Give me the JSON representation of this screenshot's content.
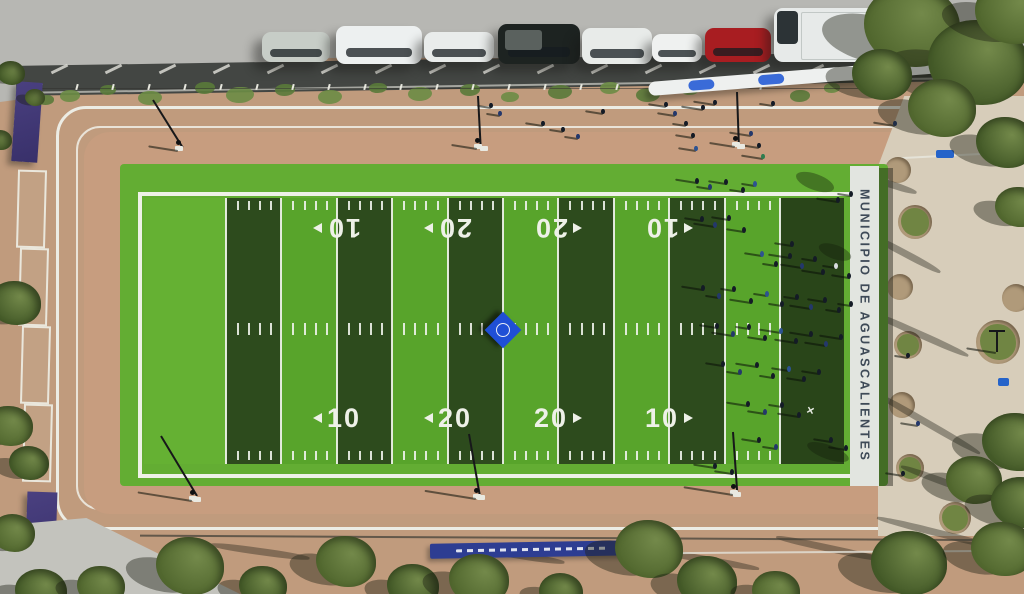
{
  "meta": {
    "description": "Aerial drone view of a municipal american-football practice field with surrounding park, parked cars and crowd"
  },
  "field": {
    "band_label": "MUNICIPIO DE AGUASCALIENTES",
    "x_mark_glyph": "✕",
    "numbers_top": [
      {
        "x": 337,
        "label": "10",
        "arrow": "right"
      },
      {
        "x": 448,
        "label": "20",
        "arrow": "right"
      },
      {
        "x": 558,
        "label": "20",
        "arrow": "left"
      },
      {
        "x": 669,
        "label": "10",
        "arrow": "left"
      }
    ],
    "numbers_bottom": [
      {
        "x": 337,
        "label": "10",
        "arrow": "left"
      },
      {
        "x": 448,
        "label": "20",
        "arrow": "left"
      },
      {
        "x": 558,
        "label": "20",
        "arrow": "right"
      },
      {
        "x": 669,
        "label": "10",
        "arrow": "right"
      }
    ],
    "interior": {
      "x0": 144,
      "x1": 844,
      "y0": 198,
      "y1": 464,
      "endzone_left_w": 82,
      "endzone_right_w": 64,
      "stripes": 10
    },
    "tick_rows_y": [
      201,
      323,
      451
    ],
    "logo": {
      "x": 503,
      "y": 330
    }
  },
  "palette": {
    "dirt": "#c09b7d",
    "dirt_light": "#cbb095",
    "road": "#b7b7b3",
    "street": "#434643",
    "field_light": "#58a42b",
    "field_lighter": "#65b133",
    "field_dark": "#2d4b1d",
    "endzone_right": "#294519",
    "line_white": "#eef1e8",
    "band_bg": "#e2e5e0",
    "plaza": "#d7cdba",
    "banner_purple": "#423977",
    "banner_blue": "#2d3d92",
    "logo_blue": "#1f4fd6",
    "tree_green": "#52682f"
  },
  "vehicles": [
    {
      "name": "silver-sedan",
      "x": 262,
      "y": 32,
      "w": 68,
      "h": 30,
      "color": "#c7cdc7"
    },
    {
      "name": "white-van",
      "x": 336,
      "y": 26,
      "w": 86,
      "h": 38,
      "color": "#edf0f0"
    },
    {
      "name": "white-hatchback",
      "x": 424,
      "y": 32,
      "w": 70,
      "h": 30,
      "color": "#e9eceb"
    },
    {
      "name": "black-pickup",
      "x": 498,
      "y": 24,
      "w": 82,
      "h": 40,
      "color": "#1d2321"
    },
    {
      "name": "white-suv",
      "x": 582,
      "y": 28,
      "w": 70,
      "h": 36,
      "color": "#e8ebe9"
    },
    {
      "name": "white-compact",
      "x": 652,
      "y": 34,
      "w": 50,
      "h": 28,
      "color": "#eff1f0"
    },
    {
      "name": "red-sedan",
      "x": 705,
      "y": 28,
      "w": 66,
      "h": 34,
      "color": "#a81d21"
    },
    {
      "name": "white-box-truck",
      "x": 774,
      "y": 8,
      "w": 150,
      "h": 54,
      "color": "#e7eae9"
    },
    {
      "name": "dark-red-car",
      "x": 928,
      "y": 26,
      "w": 56,
      "h": 36,
      "color": "#8e1317"
    }
  ],
  "stall_lines": {
    "x_start": 58,
    "x_end": 1010,
    "step": 54,
    "y": 60
  },
  "bollards": {
    "x_start": 40,
    "x_end": 770,
    "step": 36,
    "y": 84
  },
  "bushes": [
    [
      70,
      96,
      10
    ],
    [
      108,
      90,
      8
    ],
    [
      150,
      98,
      12
    ],
    [
      205,
      88,
      10
    ],
    [
      240,
      95,
      14
    ],
    [
      285,
      90,
      10
    ],
    [
      330,
      97,
      12
    ],
    [
      378,
      88,
      9
    ],
    [
      420,
      94,
      12
    ],
    [
      470,
      90,
      10
    ],
    [
      510,
      97,
      9
    ],
    [
      560,
      92,
      12
    ],
    [
      610,
      88,
      10
    ],
    [
      648,
      95,
      12
    ],
    [
      690,
      90,
      9
    ],
    [
      800,
      96,
      10
    ],
    [
      832,
      88,
      8
    ],
    [
      46,
      100,
      8
    ]
  ],
  "canopy_structure": {
    "x": 648,
    "y": 68,
    "w": 358,
    "h": 14,
    "rot": -4.5,
    "blue_patches": [
      40,
      110,
      210,
      300
    ]
  },
  "people_field": [
    [
      695,
      178,
      0
    ],
    [
      708,
      184,
      1
    ],
    [
      724,
      179,
      0
    ],
    [
      741,
      187,
      0
    ],
    [
      753,
      181,
      3
    ],
    [
      836,
      197,
      0
    ],
    [
      849,
      191,
      0
    ],
    [
      700,
      216,
      0
    ],
    [
      713,
      222,
      1
    ],
    [
      727,
      215,
      0
    ],
    [
      742,
      227,
      0
    ],
    [
      760,
      251,
      3
    ],
    [
      774,
      261,
      0
    ],
    [
      788,
      253,
      0
    ],
    [
      800,
      263,
      1
    ],
    [
      813,
      256,
      0
    ],
    [
      790,
      241,
      0
    ],
    [
      821,
      269,
      0
    ],
    [
      834,
      263,
      4
    ],
    [
      847,
      273,
      0
    ],
    [
      701,
      285,
      0
    ],
    [
      717,
      293,
      1
    ],
    [
      732,
      286,
      0
    ],
    [
      749,
      298,
      0
    ],
    [
      765,
      291,
      3
    ],
    [
      780,
      301,
      0
    ],
    [
      795,
      294,
      0
    ],
    [
      809,
      304,
      1
    ],
    [
      823,
      297,
      0
    ],
    [
      837,
      307,
      0
    ],
    [
      849,
      301,
      0
    ],
    [
      715,
      323,
      0
    ],
    [
      731,
      331,
      1
    ],
    [
      747,
      324,
      0
    ],
    [
      763,
      335,
      0
    ],
    [
      779,
      328,
      3
    ],
    [
      794,
      338,
      0
    ],
    [
      809,
      331,
      0
    ],
    [
      824,
      341,
      1
    ],
    [
      839,
      334,
      0
    ],
    [
      721,
      361,
      0
    ],
    [
      738,
      369,
      1
    ],
    [
      755,
      362,
      0
    ],
    [
      771,
      373,
      0
    ],
    [
      787,
      366,
      3
    ],
    [
      802,
      376,
      0
    ],
    [
      817,
      369,
      0
    ],
    [
      746,
      401,
      0
    ],
    [
      763,
      409,
      1
    ],
    [
      780,
      402,
      0
    ],
    [
      797,
      412,
      0
    ],
    [
      757,
      437,
      0
    ],
    [
      774,
      444,
      1
    ],
    [
      829,
      437,
      0
    ],
    [
      844,
      445,
      0
    ],
    [
      713,
      463,
      0
    ],
    [
      730,
      469,
      0
    ]
  ],
  "people_path": [
    [
      489,
      103,
      0
    ],
    [
      498,
      111,
      1
    ],
    [
      541,
      121,
      0
    ],
    [
      561,
      127,
      0
    ],
    [
      576,
      134,
      1
    ],
    [
      601,
      109,
      0
    ],
    [
      664,
      102,
      0
    ],
    [
      673,
      111,
      1
    ],
    [
      684,
      121,
      0
    ],
    [
      691,
      133,
      0
    ],
    [
      694,
      146,
      3
    ],
    [
      701,
      105,
      0
    ],
    [
      713,
      100,
      0
    ],
    [
      749,
      131,
      1
    ],
    [
      757,
      143,
      0
    ],
    [
      761,
      154,
      5
    ],
    [
      771,
      101,
      0
    ],
    [
      906,
      353,
      0
    ],
    [
      916,
      421,
      1
    ],
    [
      901,
      471,
      0
    ],
    [
      893,
      121,
      1
    ]
  ],
  "person_colors": [
    "#141b26",
    "#24386b",
    "#0c0f14",
    "#2d5391",
    "#d9dde0",
    "#2e7d4f"
  ],
  "plaza_circles": [
    [
      898,
      170,
      13,
      0
    ],
    [
      915,
      222,
      17,
      1
    ],
    [
      900,
      287,
      13,
      0
    ],
    [
      908,
      345,
      14,
      1
    ],
    [
      902,
      405,
      13,
      0
    ],
    [
      910,
      468,
      14,
      1
    ],
    [
      955,
      518,
      16,
      1
    ],
    [
      998,
      342,
      22,
      1
    ],
    [
      1016,
      298,
      14,
      0
    ]
  ],
  "plaza_bins": [
    [
      936,
      150,
      18,
      8
    ],
    [
      998,
      378,
      11,
      8
    ]
  ],
  "plaza_lamps": [
    [
      961,
      110
    ],
    [
      996,
      330
    ]
  ],
  "branch_shadows": [
    [
      905,
      250,
      80,
      28
    ],
    [
      918,
      330,
      110,
      24
    ],
    [
      928,
      420,
      120,
      30
    ],
    [
      948,
      480,
      100,
      20
    ],
    [
      888,
      180,
      60,
      18
    ],
    [
      940,
      530,
      130,
      14
    ],
    [
      700,
      555,
      120,
      10
    ],
    [
      830,
      545,
      110,
      12
    ],
    [
      260,
      548,
      100,
      8
    ],
    [
      520,
      552,
      90,
      9
    ]
  ],
  "field_shadow_blobs": [
    [
      815,
      182,
      40,
      16
    ],
    [
      835,
      252,
      34,
      14
    ],
    [
      828,
      452,
      44,
      14
    ]
  ],
  "trees": [
    [
      912,
      26,
      48,
      0
    ],
    [
      978,
      62,
      50,
      1
    ],
    [
      1013,
      12,
      38,
      0
    ],
    [
      882,
      74,
      30,
      1
    ],
    [
      942,
      108,
      34,
      0
    ],
    [
      1006,
      142,
      30,
      1
    ],
    [
      1019,
      207,
      24,
      0
    ],
    [
      1016,
      442,
      34,
      1
    ],
    [
      974,
      480,
      28,
      0
    ],
    [
      1021,
      502,
      30,
      1
    ],
    [
      190,
      566,
      34,
      0
    ],
    [
      263,
      586,
      24,
      1
    ],
    [
      346,
      561,
      30,
      0
    ],
    [
      413,
      586,
      26,
      1
    ],
    [
      479,
      579,
      30,
      0
    ],
    [
      561,
      592,
      22,
      1
    ],
    [
      649,
      549,
      34,
      0
    ],
    [
      707,
      581,
      30,
      1
    ],
    [
      776,
      591,
      24,
      0
    ],
    [
      909,
      563,
      38,
      1
    ],
    [
      1003,
      549,
      32,
      0
    ],
    [
      15,
      303,
      26,
      1
    ],
    [
      9,
      426,
      24,
      0
    ],
    [
      29,
      463,
      20,
      1
    ],
    [
      13,
      533,
      22,
      0
    ],
    [
      41,
      591,
      26,
      1
    ],
    [
      101,
      586,
      24,
      0
    ],
    [
      11,
      73,
      14,
      1
    ],
    [
      35,
      97,
      10,
      0
    ],
    [
      0,
      140,
      12,
      1
    ]
  ],
  "tree_colors": [
    "#52682f",
    "#445a28"
  ],
  "park_lamps": [
    {
      "x": 152,
      "y": 100,
      "rot": -32,
      "len": 56,
      "pad": [
        178,
        146
      ],
      "sh": 30
    },
    {
      "x": 477,
      "y": 96,
      "rot": -3,
      "len": 50,
      "pad": [
        477,
        144
      ],
      "sh": 26
    },
    {
      "x": 736,
      "y": 92,
      "rot": -2,
      "len": 52,
      "pad": [
        735,
        142
      ],
      "sh": 26
    },
    {
      "x": 160,
      "y": 436,
      "rot": -31,
      "len": 70,
      "pad": [
        192,
        496
      ],
      "sh": 55
    },
    {
      "x": 468,
      "y": 434,
      "rot": -10,
      "len": 62,
      "pad": [
        476,
        494
      ],
      "sh": 52
    },
    {
      "x": 732,
      "y": 432,
      "rot": -4,
      "len": 60,
      "pad": [
        733,
        490
      ],
      "sh": 50
    }
  ],
  "path_pads": [
    [
      480,
      146
    ],
    [
      737,
      144
    ],
    [
      193,
      497
    ],
    [
      477,
      495
    ],
    [
      733,
      492
    ],
    [
      1012,
      486
    ]
  ],
  "left_banners": {
    "purple_top": {
      "x": 14,
      "y": 82,
      "w": 26,
      "h": 80
    },
    "frames": [
      [
        17,
        170
      ],
      [
        19,
        248
      ],
      [
        21,
        326
      ],
      [
        23,
        404
      ]
    ],
    "frame_size": [
      25,
      74
    ],
    "purple_bottom": {
      "x": 26,
      "y": 492,
      "w": 30,
      "h": 84
    },
    "sun_glyph": "✳"
  },
  "bottom": {
    "blue_banner": {
      "x": 430,
      "y": 542,
      "w": 206,
      "h": 15
    },
    "white_line": {
      "x": 640,
      "y": 551,
      "w": 384
    },
    "fence_line": {
      "x": 140,
      "y": 537,
      "w": 884
    }
  }
}
